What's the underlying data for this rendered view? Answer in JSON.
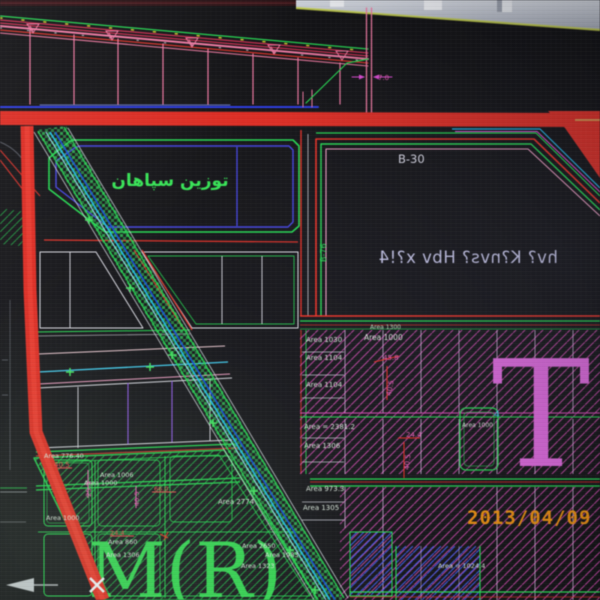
{
  "monitor": {
    "datestamp": "2013/04/09 0"
  },
  "cad": {
    "labels": {
      "tozin": "توزين سپاهان",
      "b30": "B-30",
      "b76": "B-76",
      "mirrored": "hv? K?nvs? Hbv x?!4",
      "big_t": "T",
      "big_mr": "M(R)"
    },
    "areas": {
      "r1_top_small": "Area 1300",
      "r1_top": "Area 1000",
      "r1_a": "Area 1030",
      "r1_b": "Area 1104",
      "r1_c": "Area 1104",
      "r2_a": "Area = 2381.2",
      "r2_b": "Area 1306",
      "r3_a": "Area 973.3",
      "r3_b": "Area 1305",
      "r4_a": "Area = 1024.4",
      "t_parcel": "Area 1000",
      "t_parcel_no": "4",
      "l_a": "Area 776.40",
      "l_b": "Area 1006",
      "l_c": "Area 1000",
      "l_d": "Area 1000",
      "l_e": "Area 860",
      "l_f": "Area 1306",
      "m_a": "Area 2774",
      "m_b": "Area 2650",
      "m_c": "Area 1983",
      "m_d": "Area 1323"
    },
    "dims": {
      "gap": "7.0",
      "r1_w": "45.8",
      "r1_h": "40.5",
      "r2_w": "24.4",
      "r2_h": "40.5",
      "l_w": "40.5",
      "l_v": "25.5",
      "l_w2": "66.0",
      "l_w3": "24.4",
      "l_h2": "40.5"
    },
    "colors": {
      "road_red": "#d43028",
      "parcel_green": "#2ed457",
      "water_cyan": "#2bb8e8",
      "hatch_magenta": "#cf4fb0",
      "hatch_blue": "#3f5ae0",
      "annotation_white": "#e6e6f0",
      "dim_magenta": "#e060b0",
      "datestamp_orange": "#e8941a"
    }
  }
}
